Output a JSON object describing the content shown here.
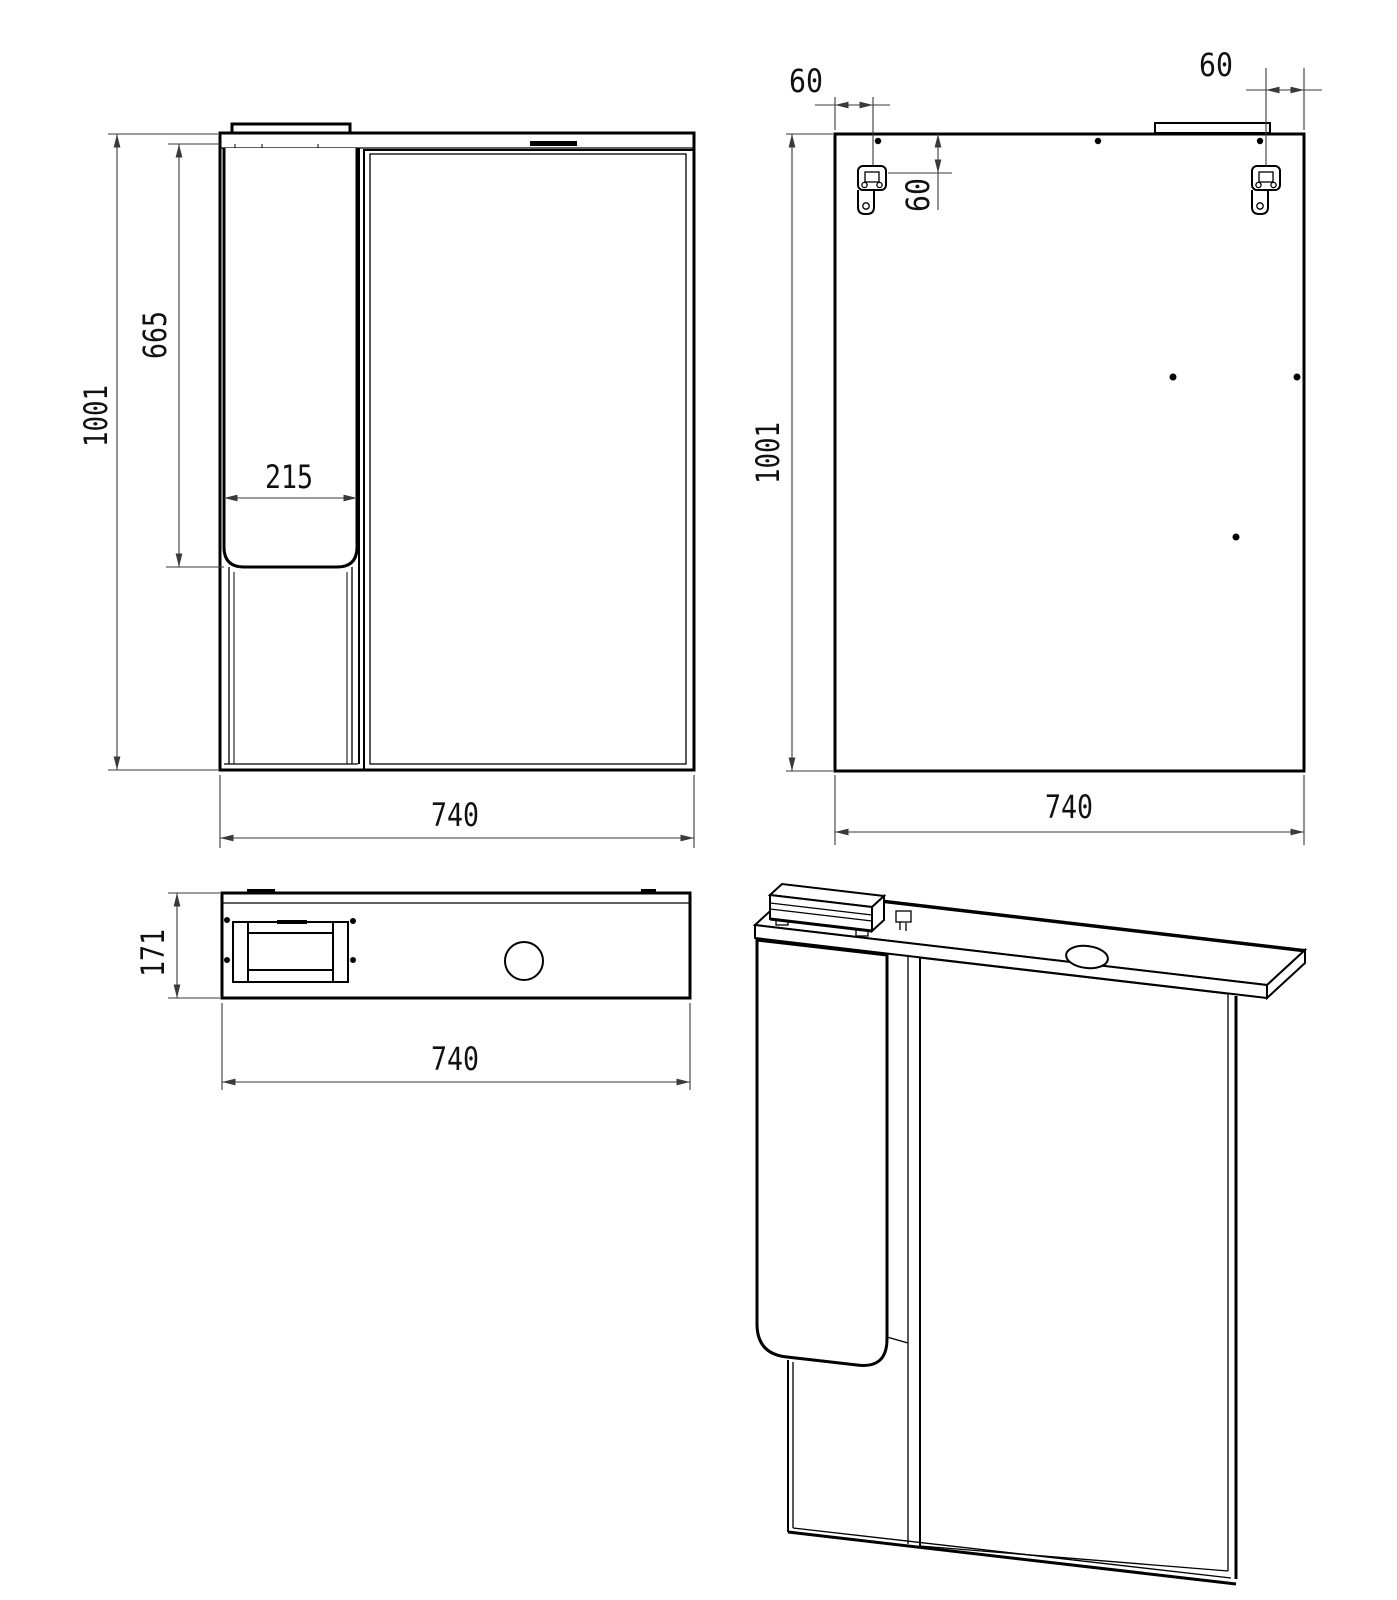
{
  "title": "Mirror cabinet technical drawing, four views",
  "colors": {
    "line": "#000000",
    "dimension": "#3a3a3a",
    "background": "#ffffff"
  },
  "views": {
    "front": {
      "labels": {
        "overall_height": "1001",
        "door_height": "665",
        "door_width": "215",
        "overall_width": "740"
      }
    },
    "back": {
      "labels": {
        "left_inset": "60",
        "right_inset": "60",
        "top_offset": "60",
        "overall_height": "1001",
        "overall_width": "740"
      }
    },
    "top": {
      "labels": {
        "depth": "171",
        "overall_width": "740"
      }
    }
  }
}
